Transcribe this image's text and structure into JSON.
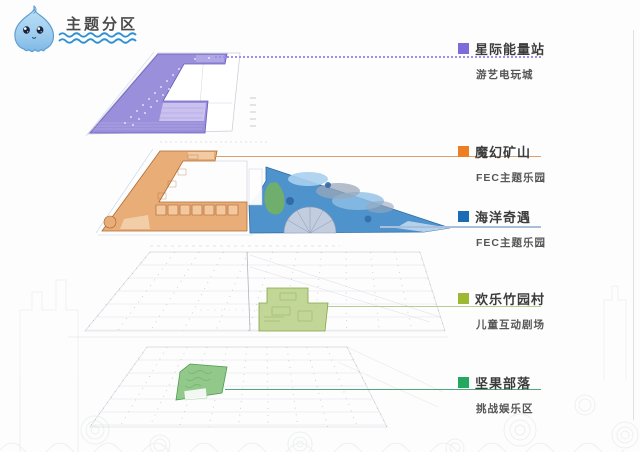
{
  "header": {
    "title": "主题分区",
    "title_color": "#4a4a4a",
    "wave_color": "#2d8fd5",
    "mascot": "water-drop-mascot"
  },
  "legend": {
    "items": [
      {
        "label": "星际能量站",
        "sublabel": "游艺电玩城",
        "swatch_color": "#7e6ad8",
        "line_color": "#9d90e2",
        "line_style": "dotted"
      },
      {
        "label": "魔幻矿山",
        "sublabel": "FEC主题乐园",
        "swatch_color": "#ee7e22",
        "line_color": "#dca06c",
        "line_style": "solid"
      },
      {
        "label": "海洋奇遇",
        "sublabel": "FEC主题乐园",
        "swatch_color": "#1c6cb5",
        "line_color": "#a9bed8",
        "line_style": "solid"
      },
      {
        "label": "欢乐竹园村",
        "sublabel": "儿童互动剧场",
        "swatch_color": "#9db832",
        "line_color": "#b7cd90",
        "line_style": "solid"
      },
      {
        "label": "坚果部落",
        "sublabel": "挑战娱乐区",
        "swatch_color": "#23a95d",
        "line_color": "#4fa87d",
        "line_style": "solid"
      }
    ]
  },
  "plans": [
    {
      "name": "starlight-energy-station-plan",
      "zone_color": "#8b7fd6"
    },
    {
      "name": "magic-mine-and-ocean-plan",
      "zone_colors": [
        "#e9ad77",
        "#4f93cc"
      ]
    },
    {
      "name": "bamboo-village-plan",
      "zone_color": "#bdd38f"
    },
    {
      "name": "nut-tribe-plan",
      "zone_color": "#8cc584"
    }
  ]
}
